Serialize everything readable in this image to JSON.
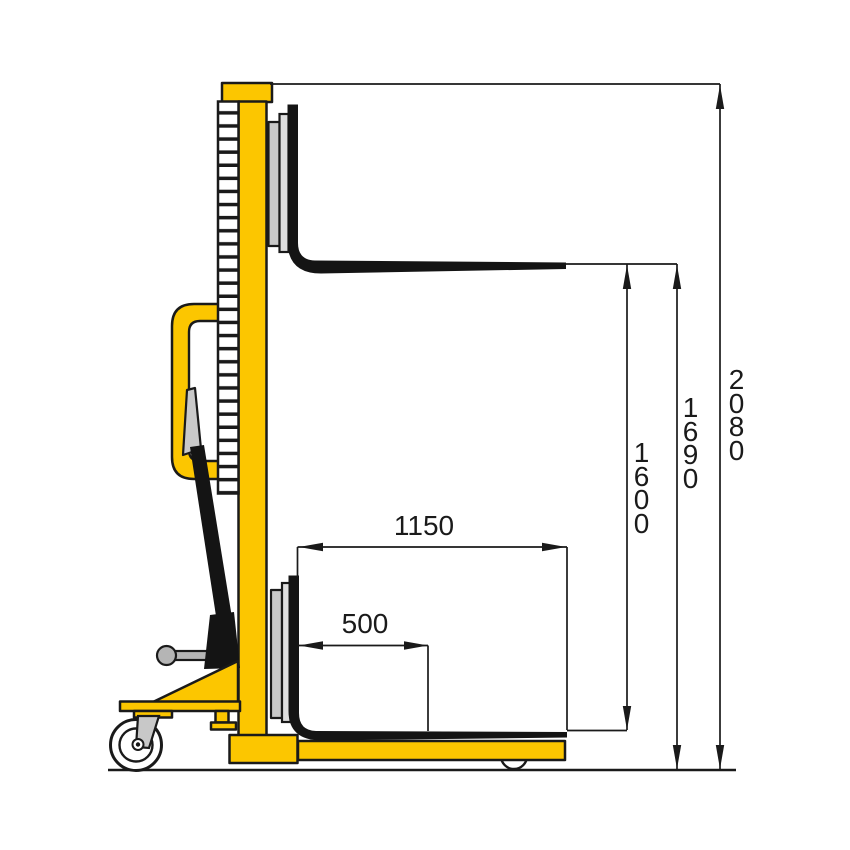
{
  "diagram": {
    "subject": "manual-hydraulic-stacker-side-view",
    "view": "side elevation with dimension lines",
    "background": "#ffffff",
    "colors": {
      "body_yellow": "#fcc600",
      "outline": "#1a1a1a",
      "steel_gray": "#c9c9c9",
      "light_gray": "#dfdfdf",
      "fork_black": "#141414",
      "background": "#ffffff"
    },
    "dimensions": {
      "fork_length": {
        "label": "1150",
        "orientation": "horizontal"
      },
      "load_center": {
        "label": "500",
        "orientation": "horizontal"
      },
      "lift_stroke": {
        "label": "1600",
        "orientation": "vertical"
      },
      "max_fork_height": {
        "label": "1690",
        "orientation": "vertical"
      },
      "overall_height": {
        "label": "2080",
        "orientation": "vertical"
      }
    }
  }
}
